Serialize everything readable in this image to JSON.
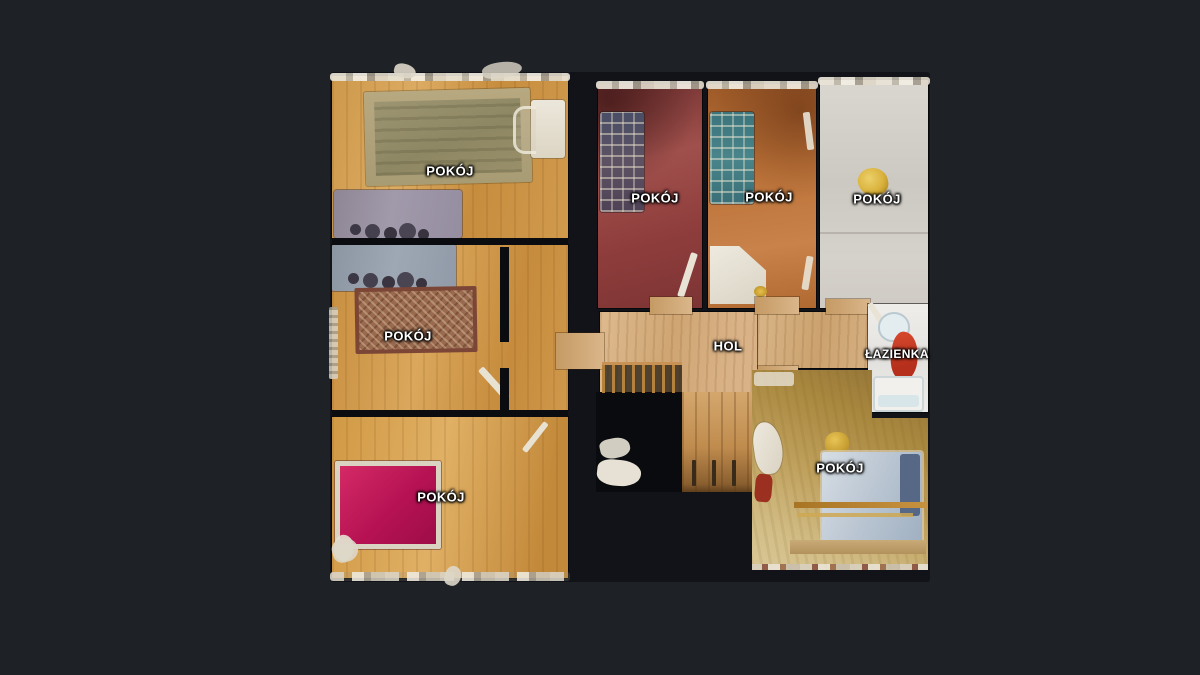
{
  "scene": {
    "type": "3d-floor-plan-top-view",
    "background_color": "#1e2125",
    "void_color": "#111318"
  },
  "floor_plan": {
    "rooms": [
      {
        "id": "pokoj-top-left",
        "label": "POKÓJ",
        "floor": "wood",
        "floor_color": "#cd984a",
        "furniture": [
          "area-rug",
          "bed",
          "desk",
          "chair"
        ]
      },
      {
        "id": "pokoj-mid-left",
        "label": "POKÓJ",
        "floor": "wood",
        "floor_color": "#c78e3f",
        "furniture": [
          "bed",
          "ornate-rug",
          "radiator",
          "door"
        ]
      },
      {
        "id": "pokoj-bottom-left",
        "label": "POKÓJ",
        "floor": "wood",
        "floor_color": "#d19944",
        "furniture": [
          "magenta-bed",
          "door"
        ]
      },
      {
        "id": "pokoj-red",
        "label": "POKÓJ",
        "floor": "red-carpet",
        "floor_color": "#8e3d3c",
        "furniture": [
          "plaid-sofa",
          "door"
        ]
      },
      {
        "id": "pokoj-orange",
        "label": "POKÓJ",
        "floor": "rust-carpet",
        "floor_color": "#bb7238",
        "furniture": [
          "teal-plaid-sofa",
          "white-desk",
          "door"
        ]
      },
      {
        "id": "pokoj-white",
        "label": "POKÓJ",
        "floor": "light",
        "floor_color": "#d2cec8",
        "furniture": [
          "gold-object"
        ]
      },
      {
        "id": "hol",
        "label": "HOL",
        "floor": "light-wood",
        "floor_color": "#d6b083",
        "furniture": [
          "staircase",
          "railing"
        ]
      },
      {
        "id": "lazienka",
        "label": "ŁAZIENKA",
        "floor": "tile",
        "floor_color": "#edebe7",
        "furniture": [
          "toilet",
          "red-towel",
          "bathtub"
        ]
      },
      {
        "id": "pokoj-bottom-right",
        "label": "POKÓJ",
        "floor": "tan-carpet",
        "floor_color": "#b4914f",
        "furniture": [
          "blue-bed",
          "armchair",
          "curtain-rods",
          "gold-cushion"
        ]
      }
    ]
  },
  "palette": {
    "label_text": "#ffffff",
    "wood_floor": "#d0984c",
    "hall_wood": "#d6b083",
    "red_carpet": "#93413f",
    "orange_carpet": "#b96f35",
    "light_floor": "#d2cec8",
    "tan_carpet": "#b4914f",
    "bathroom_tile": "#edebe7",
    "magenta_bed": "#c21e57",
    "red_towel": "#c93a27"
  }
}
